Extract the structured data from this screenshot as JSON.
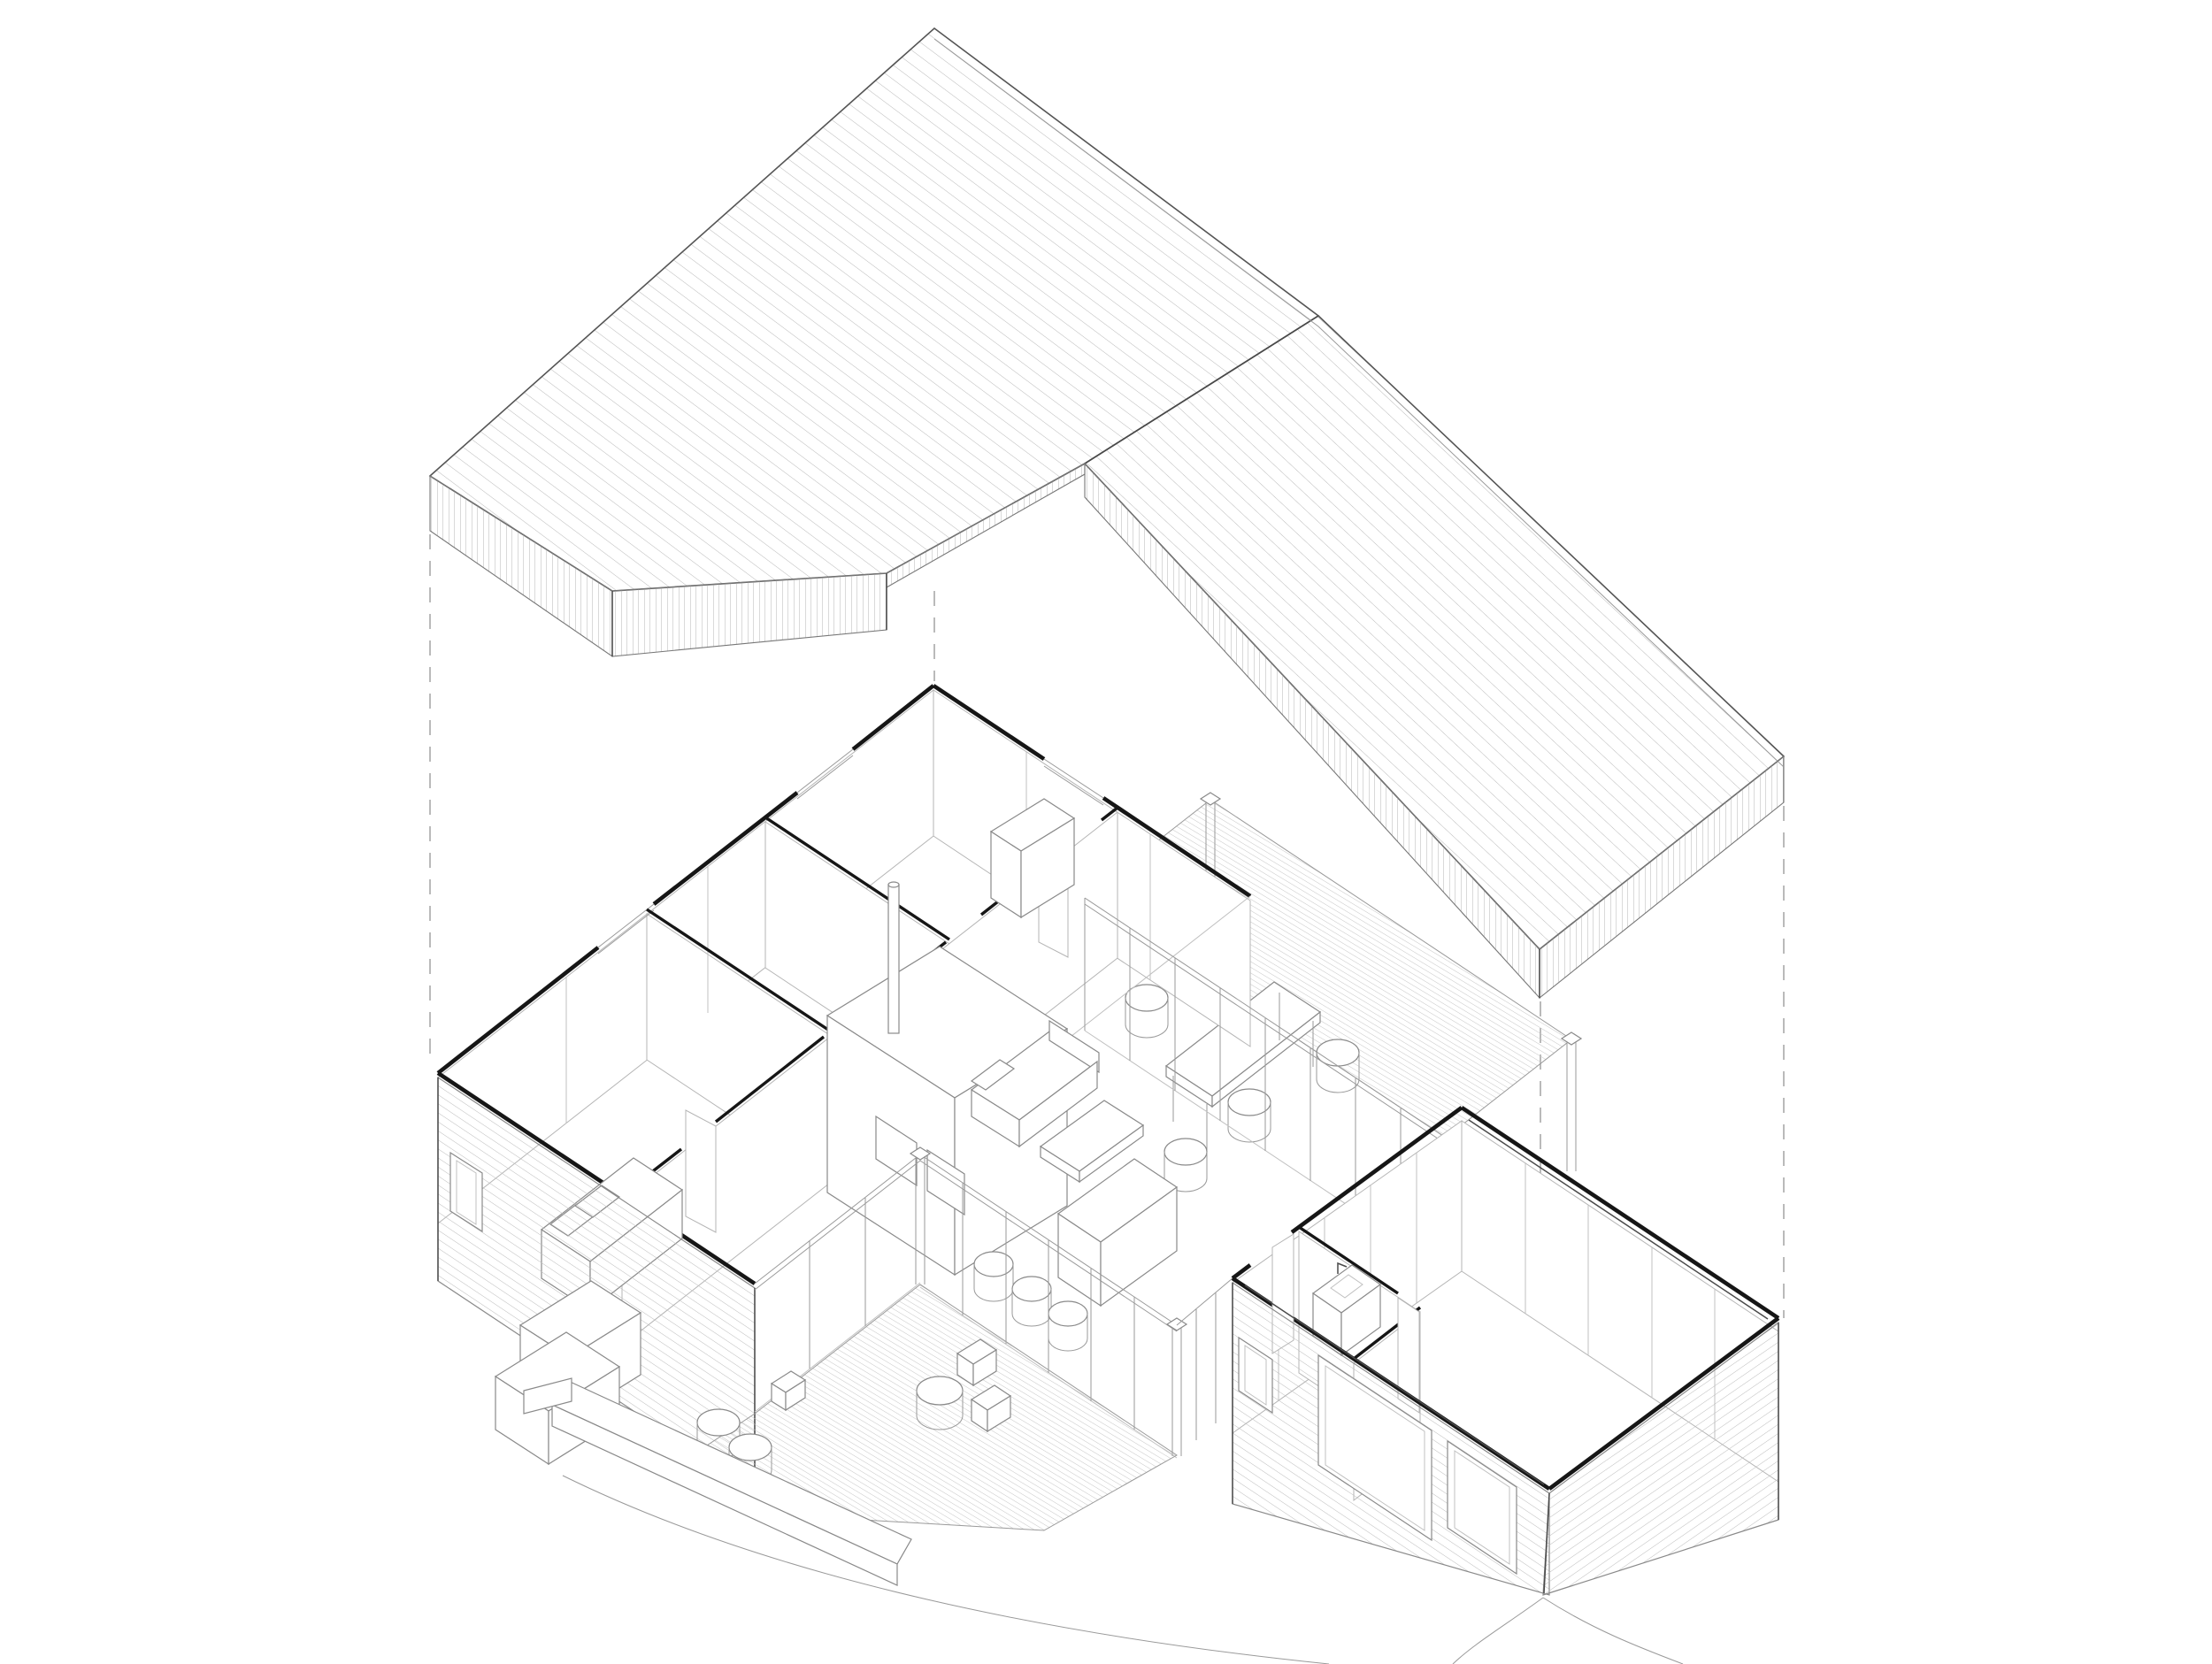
{
  "document": {
    "type": "architectural axonometric exploded drawing",
    "subject": "single-storey house: roof plane lifted above open-top floor plan",
    "background": "#ffffff",
    "visible_text": "none"
  },
  "palette": {
    "heavy_wall_cut": "#161616",
    "medium_line": "#4a4a4a",
    "light_line": "#9a9a9a",
    "hatch_line": "#b9b9b9",
    "dashed_projection": "#a3a3a3"
  },
  "components": {
    "roof": {
      "label": "roof-plane",
      "facets": [
        "left-facet-hatched",
        "right-facet-hatched"
      ],
      "edges": [
        "fascia-vertical-hatch",
        "eave-notch-step",
        "ridge-fold"
      ]
    },
    "projection": {
      "label": "dashed-projection-lines",
      "count": 4
    },
    "house": {
      "bedroom_wing": [
        "cut-wall-caps",
        "partitions",
        "door-leaves",
        "bed",
        "wardrobe",
        "siding-window"
      ],
      "living_pavilion": [
        "front-glazing",
        "back-glazing",
        "sofa",
        "coffee-table",
        "kitchen-core",
        "chimney-flue",
        "island-counter",
        "stools"
      ],
      "garage_wing": [
        "panelled-interior",
        "bathroom-sink",
        "garage-doors",
        "siding",
        "window"
      ]
    },
    "exterior": [
      "front-deck",
      "back-deck",
      "dining-table",
      "round-poufs",
      "cube-stools",
      "entry-walkway",
      "terrain-contours"
    ]
  }
}
